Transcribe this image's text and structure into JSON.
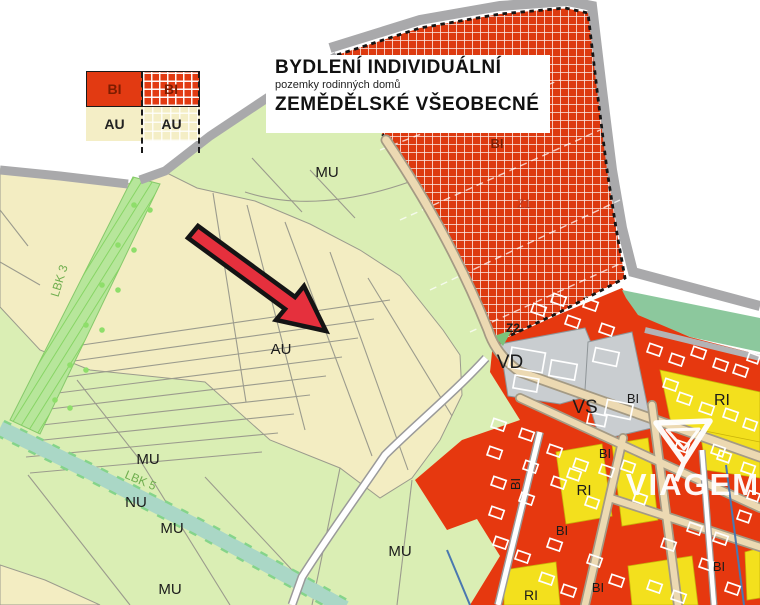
{
  "header": {
    "title1": "BYDLENÍ INDIVIDUÁLNÍ",
    "subtitle": "pozemky rodinných domů",
    "title2": "ZEMĚDĚLSKÉ VŠEOBECNÉ"
  },
  "legend": {
    "cells": [
      {
        "label": "BI",
        "type": "solid-red"
      },
      {
        "label": "BI",
        "type": "hatched-red"
      },
      {
        "label": "AU",
        "type": "cream"
      },
      {
        "label": "AU",
        "type": "cream-dashed"
      }
    ]
  },
  "watermark": {
    "text": "VIAGEM"
  },
  "colors": {
    "zone_red": "#e6380f",
    "zone_cream": "#f3edc2",
    "zone_green_light": "#daeeb4",
    "zone_yellow": "#f3e01d",
    "zone_gray": "#c9cdd0",
    "zone_sage": "#8cc89d",
    "corridor_green": "#b7e69b",
    "stream_teal": "#aad7c6",
    "road_gray": "#a9a9ab",
    "road_tan": "#ecd9b2",
    "arrow_red": "#e5303d"
  },
  "map": {
    "labels": [
      {
        "text": "MU",
        "x": 327,
        "y": 177,
        "size": 15
      },
      {
        "text": "AU",
        "x": 281,
        "y": 354,
        "size": 15
      },
      {
        "text": "MU",
        "x": 148,
        "y": 464,
        "size": 15
      },
      {
        "text": "NU",
        "x": 136,
        "y": 507,
        "size": 15
      },
      {
        "text": "MU",
        "x": 172,
        "y": 533,
        "size": 15
      },
      {
        "text": "MU",
        "x": 170,
        "y": 594,
        "size": 15
      },
      {
        "text": "MU",
        "x": 400,
        "y": 556,
        "size": 15
      },
      {
        "text": "BI",
        "x": 497,
        "y": 148,
        "size": 13,
        "color": "#7d1f04",
        "bold": true
      },
      {
        "text": "Z1",
        "x": 524,
        "y": 208,
        "size": 12,
        "color": "#b23922"
      },
      {
        "text": "Z2",
        "x": 513,
        "y": 332,
        "size": 12,
        "bold": true
      },
      {
        "text": "VD",
        "x": 510,
        "y": 368,
        "size": 19
      },
      {
        "text": "VS",
        "x": 585,
        "y": 413,
        "size": 19
      },
      {
        "text": "BI",
        "x": 633,
        "y": 403,
        "size": 13
      },
      {
        "text": "RI",
        "x": 722,
        "y": 405,
        "size": 16
      },
      {
        "text": "BI",
        "x": 605,
        "y": 458,
        "size": 13
      },
      {
        "text": "RI",
        "x": 584,
        "y": 495,
        "size": 15
      },
      {
        "text": "BI",
        "x": 562,
        "y": 535,
        "size": 13
      },
      {
        "text": "BI",
        "x": 520,
        "y": 484,
        "size": 13,
        "rot": -90
      },
      {
        "text": "BI",
        "x": 598,
        "y": 592,
        "size": 13
      },
      {
        "text": "RI",
        "x": 531,
        "y": 600,
        "size": 14
      },
      {
        "text": "BI",
        "x": 719,
        "y": 571,
        "size": 13
      },
      {
        "text": "LBK 3",
        "x": 63,
        "y": 282,
        "size": 12,
        "color": "#6fae4e",
        "rot": -73
      },
      {
        "text": "LBK 5",
        "x": 139,
        "y": 484,
        "size": 12,
        "color": "#6fae4e",
        "rot": 23
      }
    ]
  }
}
